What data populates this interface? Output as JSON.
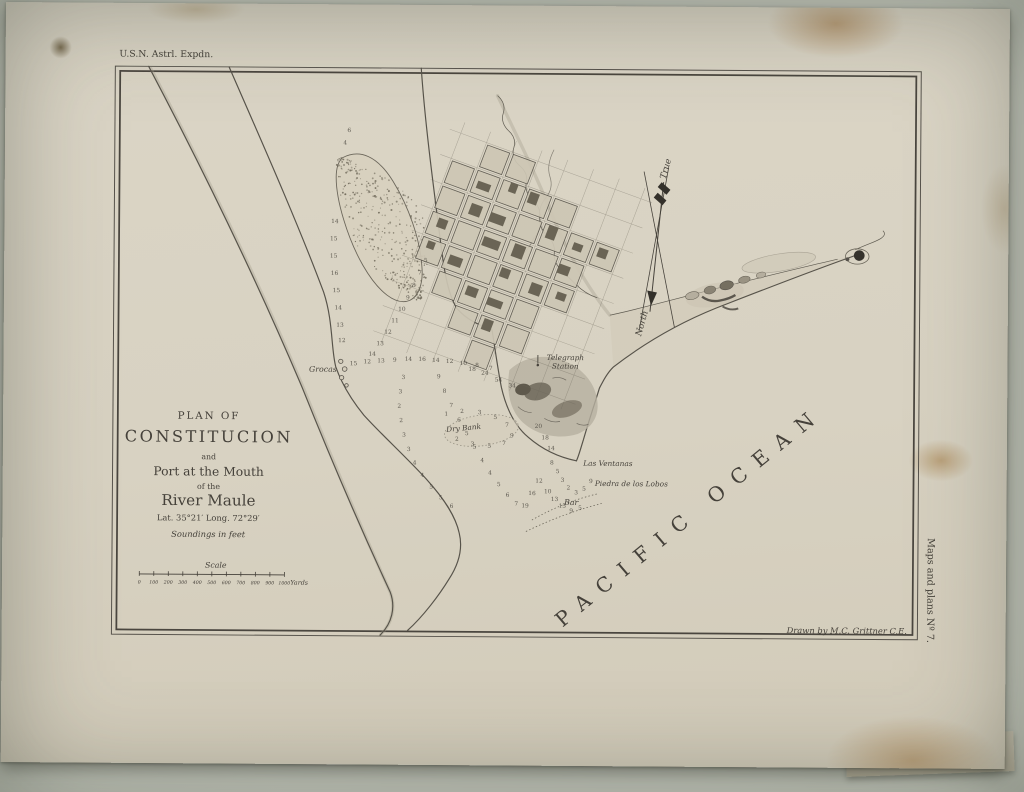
{
  "colors": {
    "ink": "#45413a",
    "paper": "#d8d2c2",
    "backdrop": "#cbcec3",
    "hill_dark": "#6f695c"
  },
  "annotations": {
    "top_left": "U.S.N. Astrl. Expdn.",
    "drawn_by": "Drawn by M.C. Grittner C.E.",
    "side_note": "Maps and plans Nº 7."
  },
  "title_block": {
    "lines": [
      "PLAN OF",
      "CONSTITUCION",
      "and",
      "Port at the Mouth",
      "of the",
      "River Maule",
      "Lat. 35°21′ Long. 72°29′",
      "Soundings in feet"
    ]
  },
  "scale_bar": {
    "label": "Scale",
    "ticks": [
      "0",
      "100",
      "200",
      "300",
      "400",
      "500",
      "600",
      "700",
      "800",
      "900",
      "1000"
    ],
    "unit": "Yards"
  },
  "ocean_label": "PACIFIC OCEAN",
  "compass": {
    "true_label": "True",
    "north_label": "North"
  },
  "places": [
    {
      "t": "Grocas",
      "x": 340,
      "y": 383,
      "s": 8,
      "a": "end",
      "r": 0
    },
    {
      "t": "Telegraph",
      "x": 573,
      "y": 369,
      "s": 7.5,
      "a": "middle",
      "r": 0
    },
    {
      "t": "Station",
      "x": 573,
      "y": 378,
      "s": 7.5,
      "a": "middle",
      "r": 0
    },
    {
      "t": "Dry Bank",
      "x": 470,
      "y": 443,
      "s": 7.5,
      "a": "middle",
      "r": -6
    },
    {
      "t": "Las Ventanas",
      "x": 592,
      "y": 479,
      "s": 7.5,
      "a": "start",
      "r": 0
    },
    {
      "t": "Piedra de los Lobos",
      "x": 604,
      "y": 500,
      "s": 7.5,
      "a": "start",
      "r": 0
    },
    {
      "t": "Bar",
      "x": 580,
      "y": 520,
      "s": 8,
      "a": "middle",
      "r": 0
    }
  ],
  "soundings": [
    [
      337,
      228,
      14
    ],
    [
      336,
      246,
      15
    ],
    [
      336,
      264,
      15
    ],
    [
      337,
      282,
      16
    ],
    [
      339,
      300,
      15
    ],
    [
      341,
      318,
      14
    ],
    [
      343,
      336,
      13
    ],
    [
      345,
      352,
      12
    ],
    [
      347,
      146,
      4
    ],
    [
      351,
      133,
      6
    ],
    [
      357,
      376,
      15
    ],
    [
      371,
      374,
      12
    ],
    [
      385,
      373,
      13
    ],
    [
      399,
      372,
      9
    ],
    [
      413,
      371,
      14
    ],
    [
      427,
      371,
      16
    ],
    [
      441,
      372,
      14
    ],
    [
      455,
      373,
      12
    ],
    [
      469,
      375,
      10
    ],
    [
      483,
      377,
      8
    ],
    [
      497,
      380,
      7
    ],
    [
      430,
      268,
      5
    ],
    [
      424,
      281,
      7
    ],
    [
      418,
      294,
      8
    ],
    [
      412,
      307,
      9
    ],
    [
      406,
      319,
      10
    ],
    [
      399,
      331,
      11
    ],
    [
      392,
      343,
      12
    ],
    [
      384,
      355,
      13
    ],
    [
      376,
      366,
      14
    ],
    [
      444,
      389,
      9
    ],
    [
      450,
      404,
      8
    ],
    [
      457,
      419,
      7
    ],
    [
      465,
      434,
      6
    ],
    [
      473,
      448,
      5
    ],
    [
      481,
      462,
      5
    ],
    [
      489,
      476,
      4
    ],
    [
      497,
      489,
      4
    ],
    [
      506,
      501,
      5
    ],
    [
      515,
      512,
      6
    ],
    [
      524,
      521,
      7
    ],
    [
      408,
      390,
      3
    ],
    [
      405,
      405,
      3
    ],
    [
      404,
      420,
      2
    ],
    [
      406,
      435,
      2
    ],
    [
      409,
      450,
      3
    ],
    [
      414,
      465,
      3
    ],
    [
      420,
      479,
      4
    ],
    [
      428,
      492,
      4
    ],
    [
      437,
      504,
      5
    ],
    [
      447,
      515,
      5
    ],
    [
      458,
      524,
      6
    ],
    [
      560,
      478,
      8
    ],
    [
      566,
      487,
      5
    ],
    [
      571,
      496,
      3
    ],
    [
      577,
      504,
      2
    ],
    [
      585,
      509,
      3
    ],
    [
      593,
      505,
      5
    ],
    [
      600,
      497,
      9
    ],
    [
      556,
      508,
      10
    ],
    [
      563,
      516,
      13
    ],
    [
      571,
      523,
      15
    ],
    [
      580,
      528,
      9
    ],
    [
      589,
      525,
      5
    ],
    [
      547,
      497,
      12
    ],
    [
      540,
      510,
      16
    ],
    [
      533,
      523,
      19
    ],
    [
      505,
      392,
      54
    ],
    [
      519,
      398,
      34
    ],
    [
      491,
      385,
      24
    ],
    [
      478,
      381,
      18
    ],
    [
      546,
      440,
      20
    ],
    [
      553,
      452,
      18
    ],
    [
      559,
      463,
      14
    ],
    [
      452,
      428,
      1
    ],
    [
      468,
      425,
      2
    ],
    [
      486,
      426,
      3
    ],
    [
      502,
      431,
      5
    ],
    [
      514,
      439,
      7
    ],
    [
      519,
      450,
      9
    ],
    [
      511,
      458,
      7
    ],
    [
      496,
      461,
      5
    ],
    [
      479,
      459,
      3
    ],
    [
      463,
      454,
      2
    ]
  ]
}
